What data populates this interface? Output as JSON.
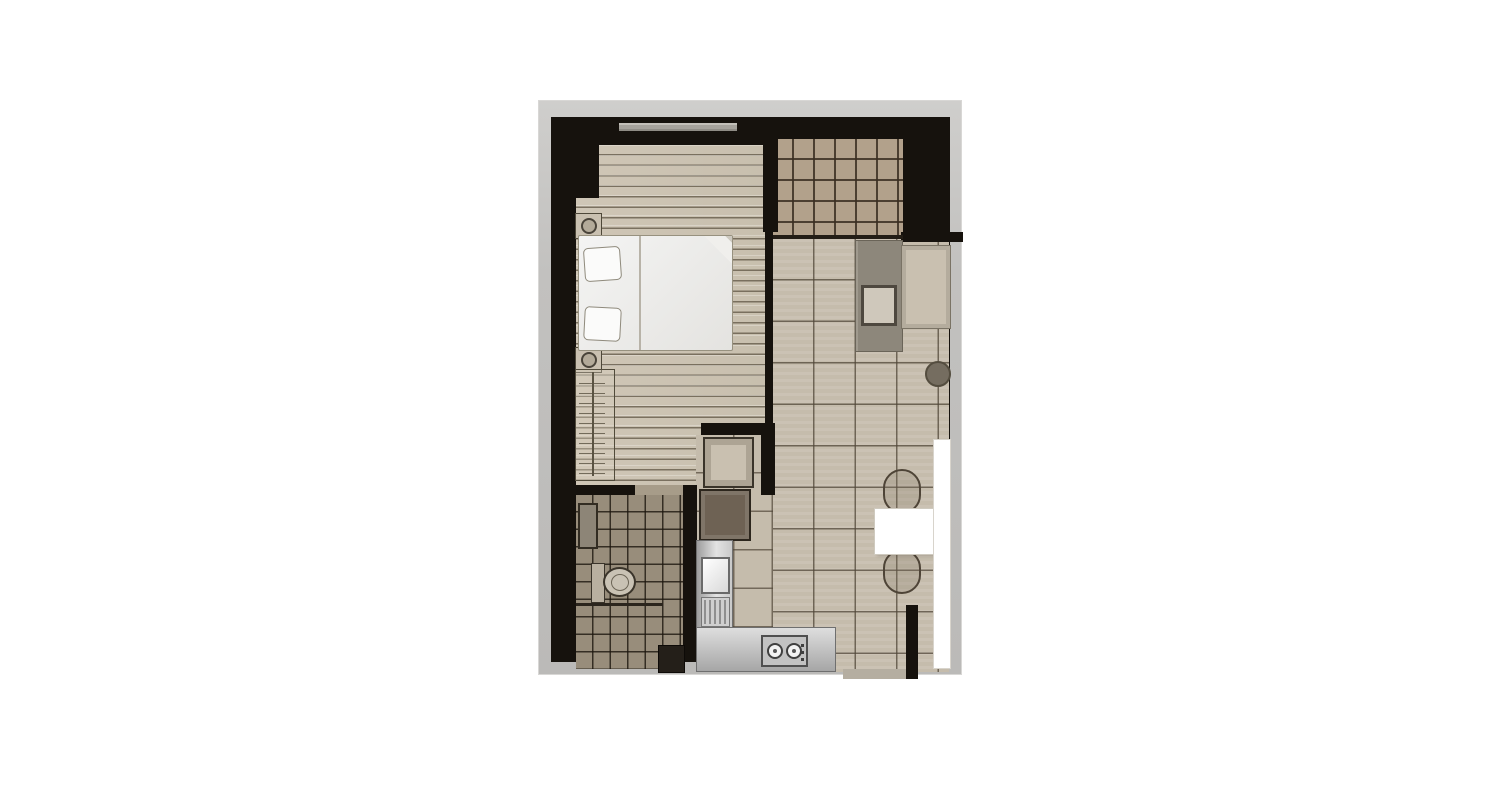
{
  "title": "one-bedroom-unit-floor-plan",
  "palette": {
    "page_bg": "#ffffff",
    "frame": "#c2c1bf",
    "wall": "#16120d",
    "bedroom_floor": "#cfc6b6",
    "balcony_tile": "#b2a18b",
    "living_tile": "#c5bcac",
    "bathroom_tile": "#988d7b",
    "furniture_light": "#c9c0b0",
    "sofa": "#8d877b",
    "appliance": "#c2c2c2",
    "white": "#ffffff"
  },
  "rooms": [
    {
      "name": "bedroom",
      "floor": "wood-planks"
    },
    {
      "name": "balcony",
      "floor": "small-grid-tiles"
    },
    {
      "name": "living-dining",
      "floor": "large-tiles"
    },
    {
      "name": "kitchen-hall",
      "floor": "large-tiles"
    },
    {
      "name": "bathroom",
      "floor": "dark-grid-tiles"
    }
  ],
  "furniture": [
    "double-bed-with-two-pillows",
    "nightstand-top",
    "nightstand-bottom",
    "wardrobe",
    "sofa",
    "sofa-side-table",
    "lounge-rug",
    "round-side-table",
    "dining-table",
    "dining-chair-top",
    "dining-chair-bottom",
    "counter-ledge",
    "entry-cabinet",
    "refrigerator",
    "kitchen-counter",
    "sink",
    "drainboard",
    "two-burner-stove",
    "vanity-basin",
    "toilet",
    "shower-partition",
    "utility-box"
  ]
}
